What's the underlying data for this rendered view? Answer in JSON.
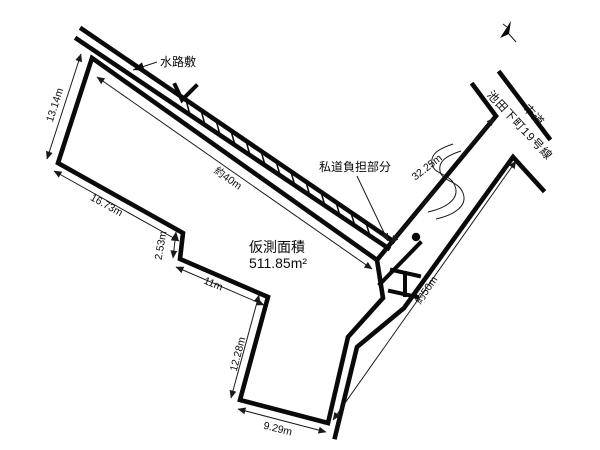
{
  "diagram_type": "land-survey-plot",
  "colors": {
    "line": "#0a0a0a",
    "background": "#ffffff"
  },
  "labels": {
    "waterway": "水路敷",
    "private_road_portion": "私道負担部分",
    "area_caption": "仮測面積",
    "area_value": "511.85m²",
    "road_line1": "市道",
    "road_line2": "池田下町19号線"
  },
  "dims": {
    "west_edge": "13.14m",
    "southwest_edge": "16.73m",
    "jog_edge": "2.53m",
    "mid_edge": "11m",
    "south_edge": "12.28m",
    "bottom_edge": "9.29m",
    "north_edge_approx": "約40m",
    "road_upper": "32.25m",
    "road_total_approx": "約50m"
  }
}
